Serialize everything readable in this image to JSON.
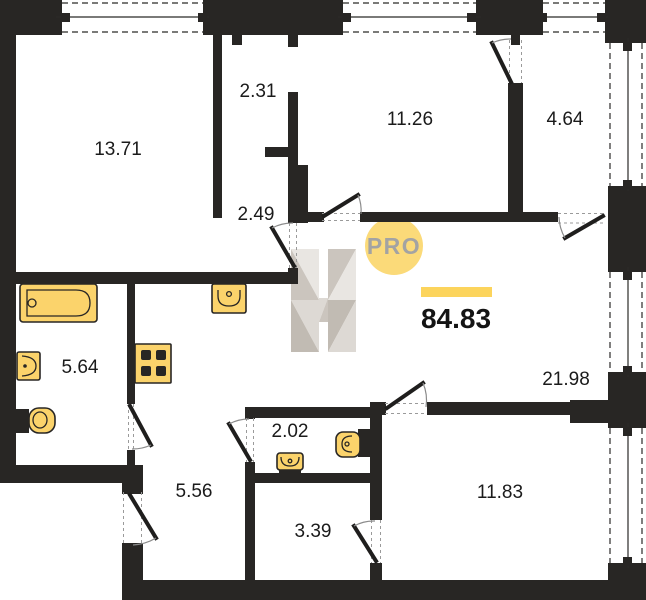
{
  "plan": {
    "type": "apartment-floor-plan",
    "total_area_label": "84.83",
    "badge_label": "PRO",
    "rooms": [
      {
        "area": "13.71"
      },
      {
        "area": "2.31"
      },
      {
        "area": "11.26"
      },
      {
        "area": "4.64"
      },
      {
        "area": "2.49"
      },
      {
        "area": "5.64"
      },
      {
        "area": "21.98"
      },
      {
        "area": "2.02"
      },
      {
        "area": "5.56"
      },
      {
        "area": "3.39"
      },
      {
        "area": "11.83"
      }
    ],
    "fixtures": [
      "bathtub",
      "wash-basin",
      "toilet",
      "kitchen-sink",
      "stove-4-burner",
      "wc-sink",
      "wc-toilet"
    ],
    "colors": {
      "wall": "#282624",
      "fixture_fill": "#fbd36b",
      "accent_bar": "#fcd45c",
      "badge_circle": "#fbda79",
      "badge_text": "#a3a3a3",
      "logo_gray_light": "#e9e6e2",
      "logo_gray_mid": "#cbc5be",
      "label_text": "#1b1b1b"
    }
  }
}
